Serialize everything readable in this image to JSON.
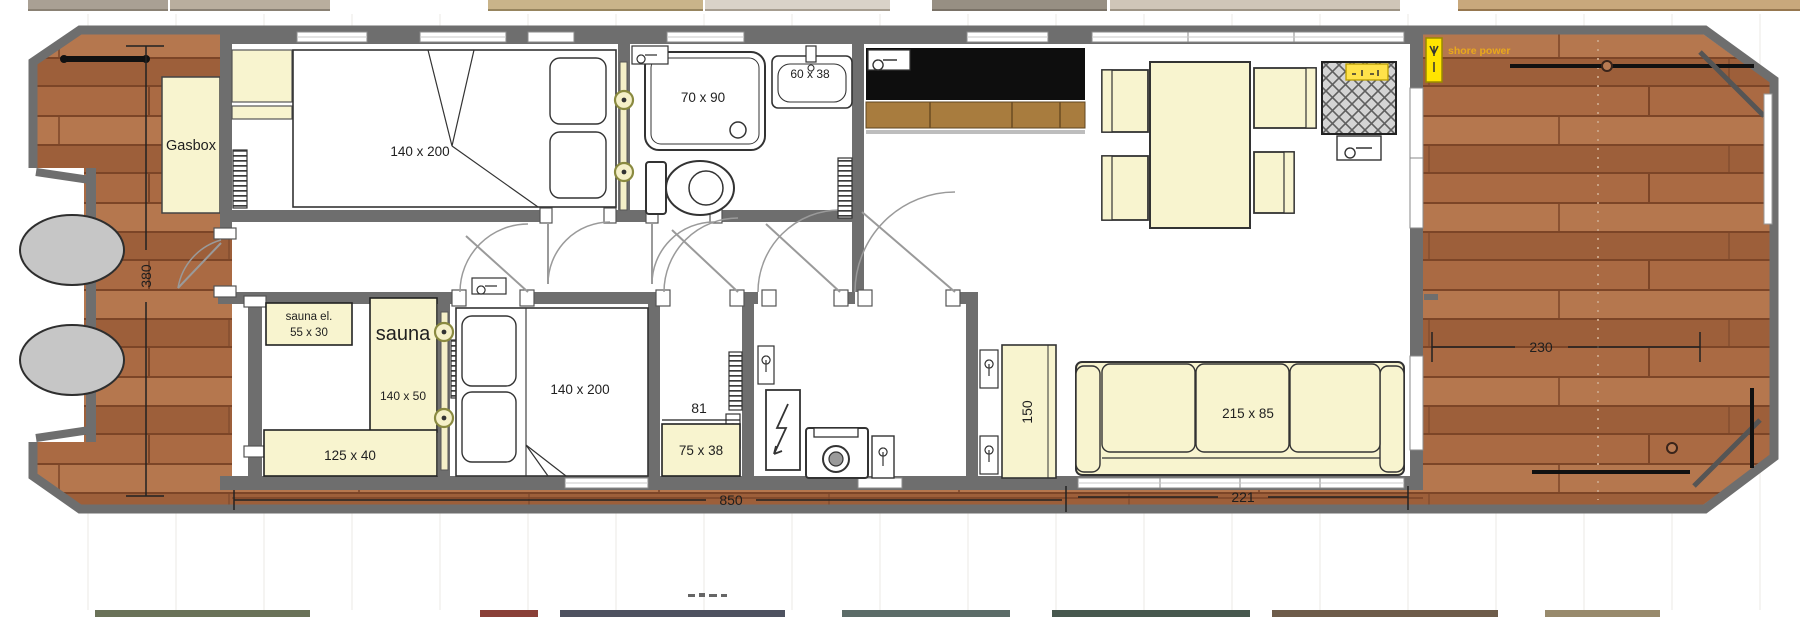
{
  "deck_bow": {
    "dimension": "380",
    "gasbox": "Gasbox"
  },
  "deck_stern": {
    "dimension": "230",
    "shore_power": "shore power"
  },
  "bedroom1": {
    "bed": "140 x 200"
  },
  "bathroom": {
    "shower": "70 x 90",
    "sink": "60 x 38"
  },
  "sauna": {
    "name": "sauna",
    "heater_l1": "sauna el.",
    "heater_l2": "55 x 30",
    "bench_side": "140 x 50",
    "bench_bottom": "125 x 40"
  },
  "bedroom2": {
    "bed": "140 x 200"
  },
  "hall": {
    "width": "81",
    "cabinet": "75 x 38"
  },
  "living": {
    "cabinet": "150",
    "sofa": "215 x 85",
    "window_width": "221"
  },
  "dims": {
    "bottom": "850"
  },
  "colors": {
    "wall": "#6e6e6e",
    "wood": "#a96b45",
    "wood_seam": "#7c4527",
    "furniture_cream": "#f8f4cf",
    "counter_black": "#0e0e0e",
    "cabinet_brown": "#a87c3e",
    "accent_yellow": "#ffe400",
    "shore_power_text": "#e9a81c",
    "engine_gray": "#c6c6c6"
  }
}
